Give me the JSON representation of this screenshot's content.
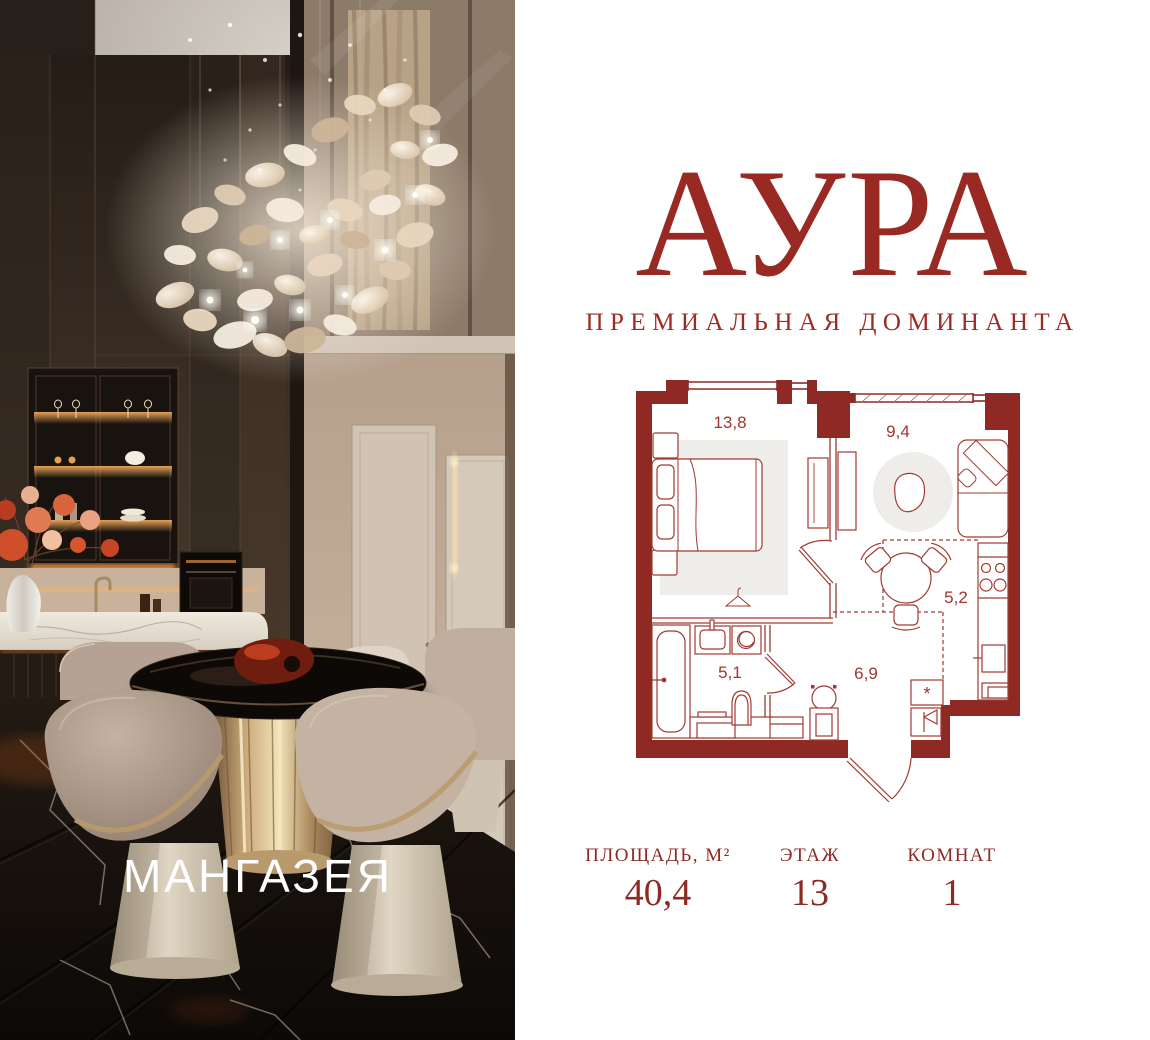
{
  "brand": {
    "logo": "АУРА",
    "tagline": "ПРЕМИАЛЬНАЯ ДОМИНАНТА",
    "photo_watermark": "МАНГАЗЕЯ"
  },
  "plan": {
    "rooms": [
      {
        "name": "bedroom",
        "area": "13,8"
      },
      {
        "name": "living-room",
        "area": "9,4"
      },
      {
        "name": "kitchen",
        "area": "5,2"
      },
      {
        "name": "bathroom",
        "area": "5,1"
      },
      {
        "name": "hallway",
        "area": "6,9"
      }
    ],
    "washer_symbol": "*"
  },
  "stats": {
    "area": {
      "label": "ПЛОЩАДЬ, М²",
      "value": "40,4"
    },
    "floor": {
      "label": "ЭТАЖ",
      "value": "13"
    },
    "rooms": {
      "label": "КОМНАТ",
      "value": "1"
    }
  },
  "colors": {
    "accent": "#992A23",
    "plan_wall": "#8E2A23",
    "plan_line": "#A23A31",
    "plan_rug": "#EFEDEA"
  }
}
